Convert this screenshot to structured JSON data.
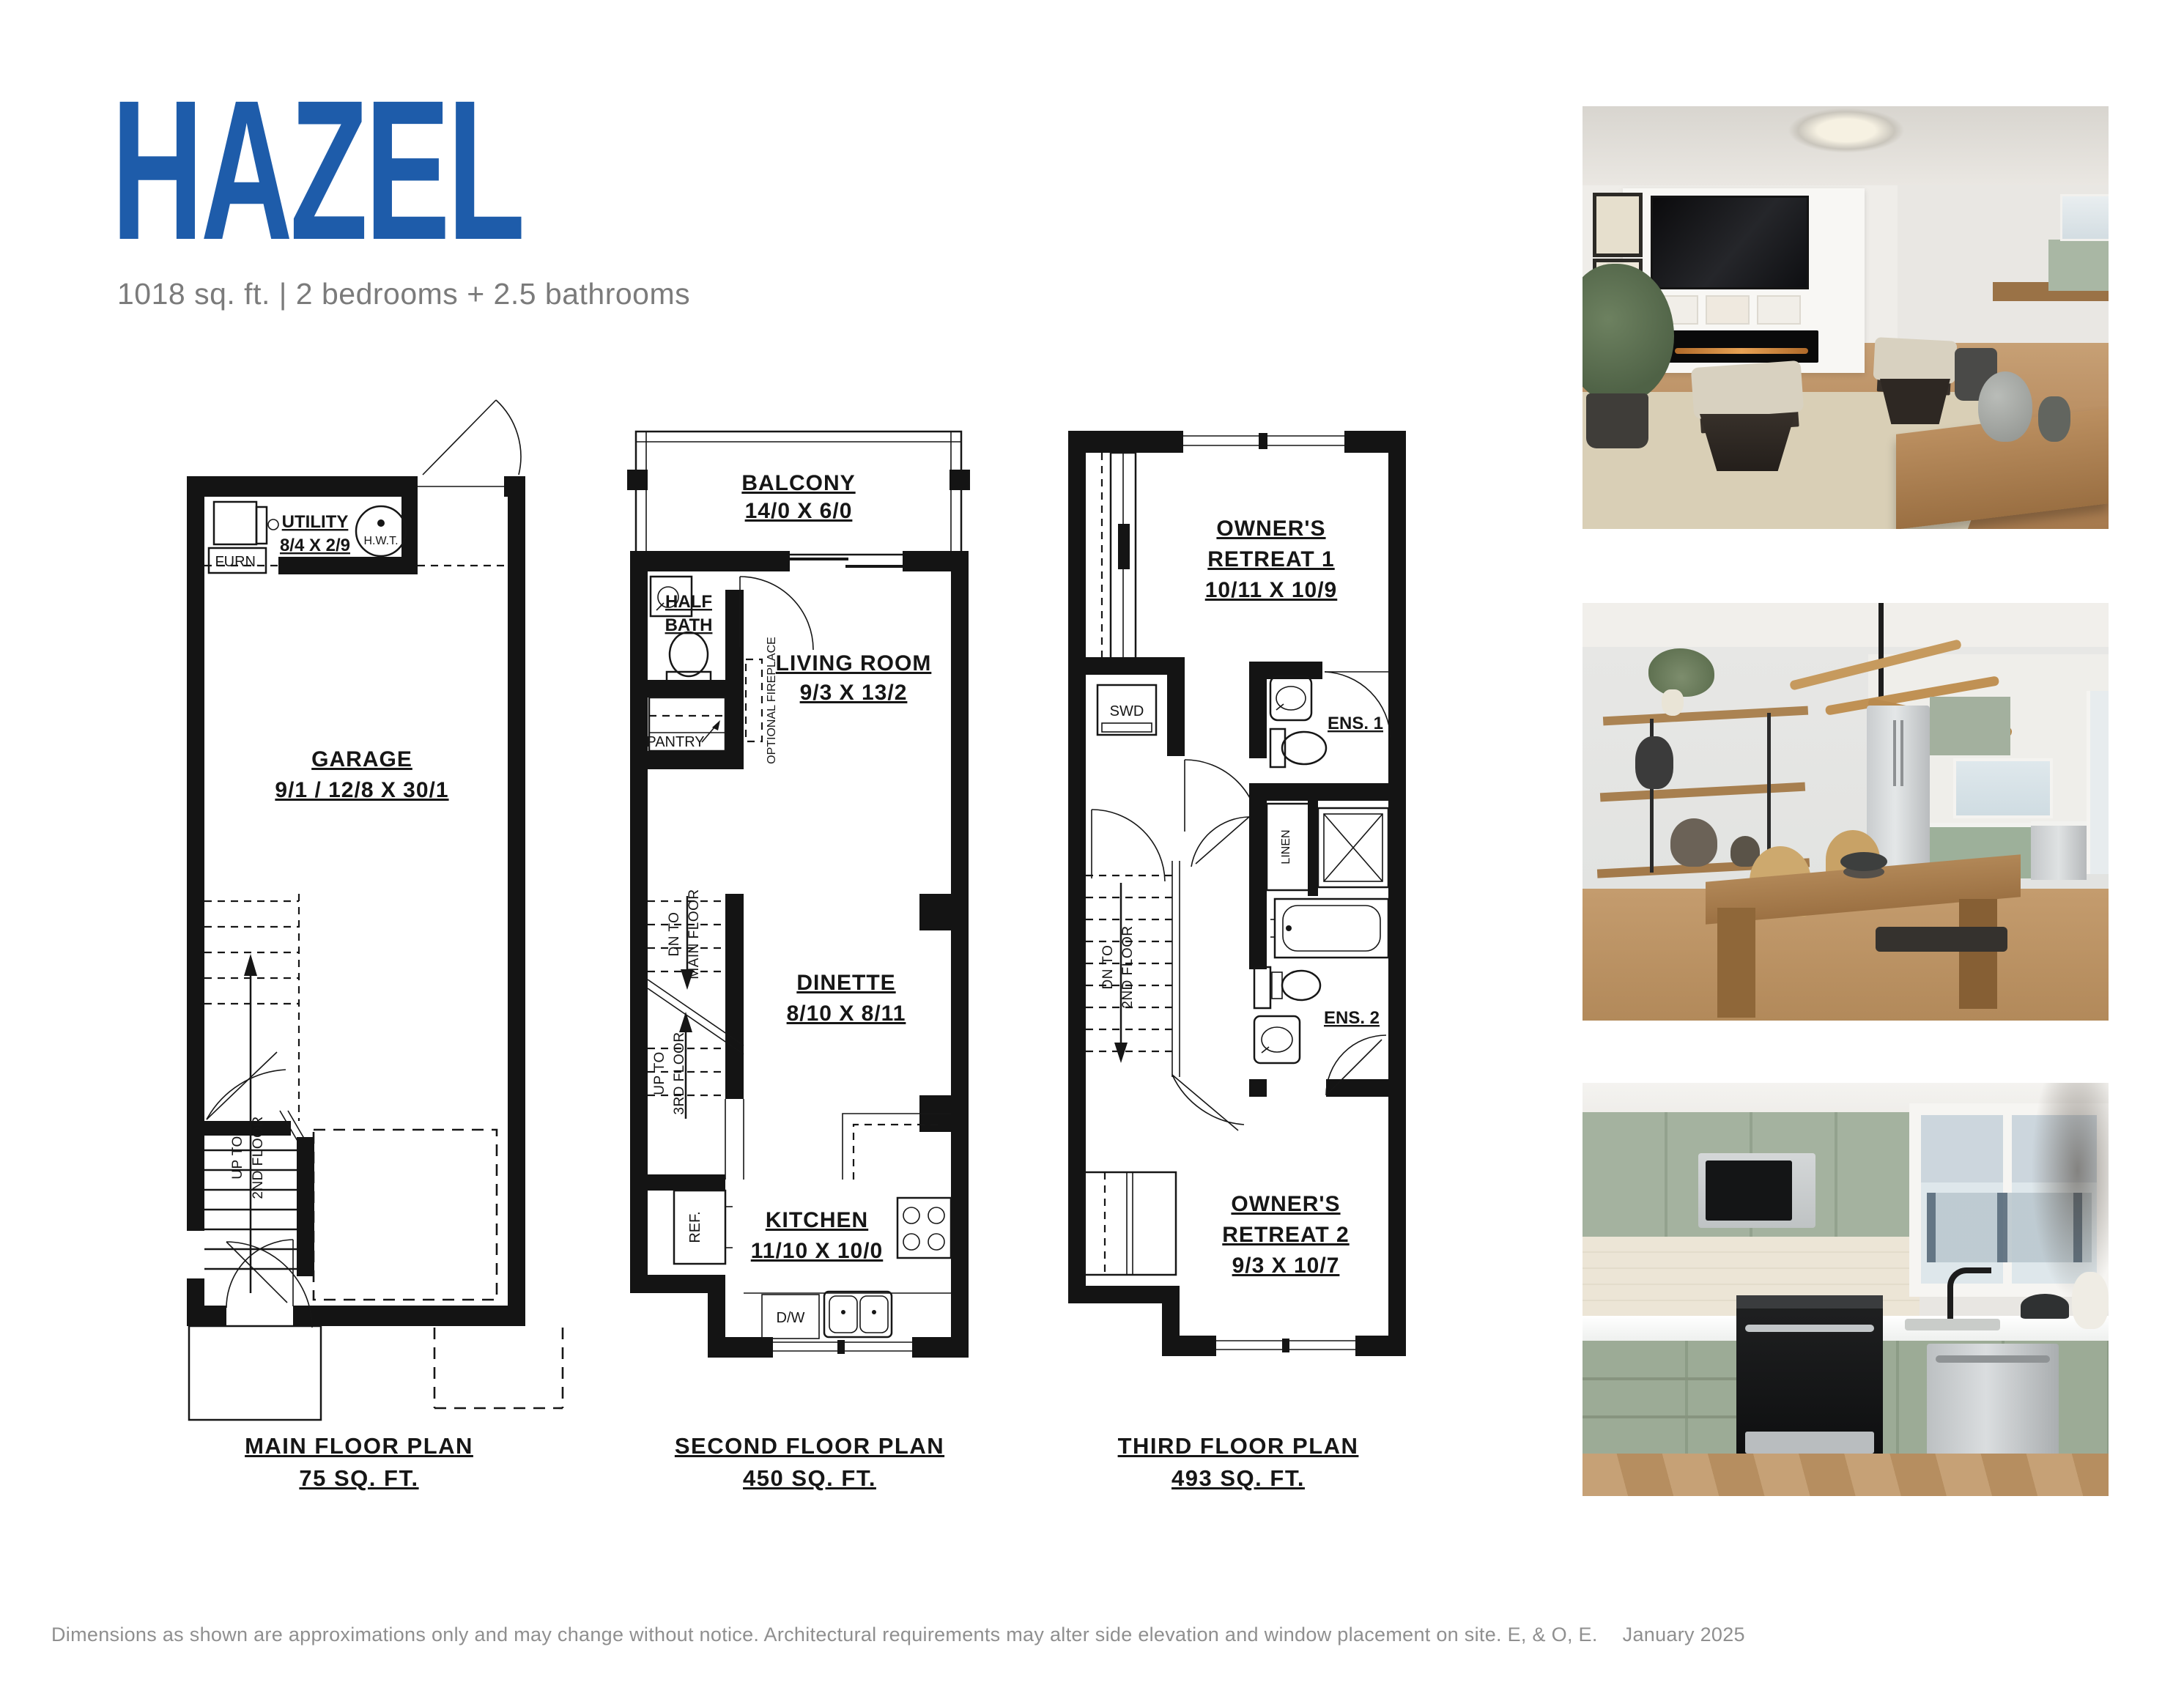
{
  "header": {
    "title": "HAZEL",
    "subtitle": "1018 sq. ft.  |  2 bedrooms + 2.5 bathrooms"
  },
  "colors": {
    "accent_blue": "#1e5caa",
    "subtitle_gray": "#7b7b7b",
    "plan_line_black": "#161616",
    "cabinet_green": "#a9b7a4",
    "wood_floor": "#c19a6b"
  },
  "plans": {
    "main": {
      "title": "MAIN FLOOR PLAN",
      "area": "75 SQ. FT.",
      "utility_name": "UTILITY",
      "utility_dims": "8/4 X 2/9",
      "furn": "FURN.",
      "hwt": "H.W.T.",
      "garage_name": "GARAGE",
      "garage_dims": "9/1 / 12/8 X 30/1",
      "stairs_line1": "UP TO",
      "stairs_line2": "2ND FLOOR"
    },
    "second": {
      "title": "SECOND FLOOR PLAN",
      "area": "450 SQ. FT.",
      "balcony_name": "BALCONY",
      "balcony_dims": "14/0 X 6/0",
      "half_bath_line1": "HALF",
      "half_bath_line2": "BATH",
      "living_name": "LIVING ROOM",
      "living_dims": "9/3 X 13/2",
      "optional_fireplace": "OPTIONAL FIREPLACE",
      "pantry": "PANTRY",
      "stairs_dn_line1": "DN TO",
      "stairs_dn_line2": "MAIN FLOOR",
      "stairs_up_line1": "UP TO",
      "stairs_up_line2": "3RD FLOOR",
      "dinette_name": "DINETTE",
      "dinette_dims": "8/10 X 8/11",
      "kitchen_name": "KITCHEN",
      "kitchen_dims": "11/10 X 10/0",
      "ref": "REF.",
      "dw": "D/W"
    },
    "third": {
      "title": "THIRD FLOOR PLAN",
      "area": "493 SQ. FT.",
      "retreat1_line1": "OWNER'S",
      "retreat1_line2": "RETREAT 1",
      "retreat1_dims": "10/11 X 10/9",
      "swd": "SWD",
      "ens1": "ENS. 1",
      "linen": "LINEN",
      "stairs_dn_line1": "DN TO",
      "stairs_dn_line2": "2ND FLOOR",
      "ens2": "ENS. 2",
      "retreat2_line1": "OWNER'S",
      "retreat2_line2": "RETREAT 2",
      "retreat2_dims": "9/3 X 10/7"
    }
  },
  "footer": {
    "disclaimer": "Dimensions as shown are approximations only and may change without notice. Architectural requirements may alter side elevation and window placement on site. E, & O, E.",
    "date": "January 2025"
  }
}
